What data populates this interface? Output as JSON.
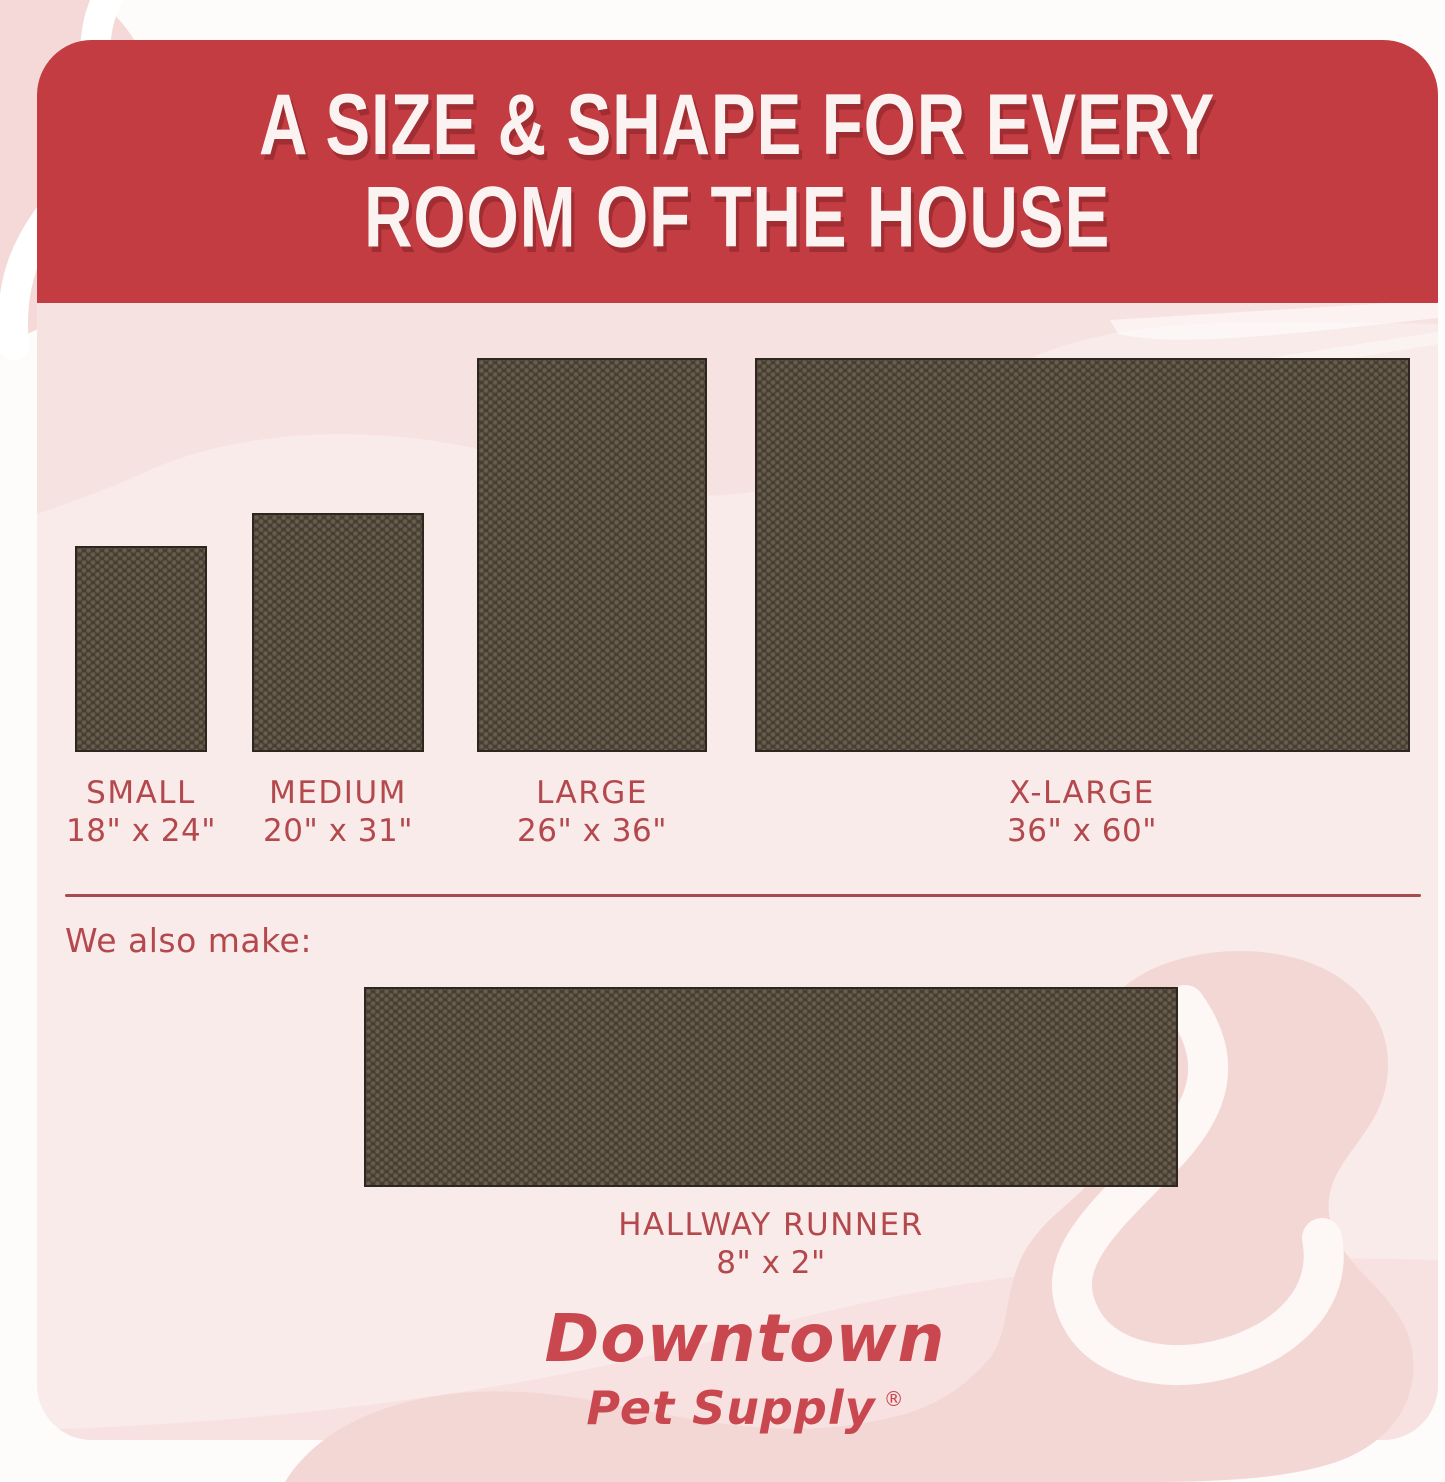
{
  "header": {
    "title_line1": "A SIZE & SHAPE FOR EVERY",
    "title_line2": "ROOM OF THE HOUSE"
  },
  "sizes": [
    {
      "name": "SMALL",
      "dimensions": "18\" x 24\""
    },
    {
      "name": "MEDIUM",
      "dimensions": "20\" x 31\""
    },
    {
      "name": "LARGE",
      "dimensions": "26\" x 36\""
    },
    {
      "name": "X-LARGE",
      "dimensions": "36\" x 60\""
    }
  ],
  "also_make": {
    "intro": "We also make:",
    "name": "HALLWAY RUNNER",
    "dimensions": "8\" x 2\""
  },
  "brand": {
    "line1": "Downtown",
    "line2": "Pet Supply",
    "registered_mark": "®"
  },
  "colors": {
    "header_red": "#c23c42",
    "label_red": "#b4494d",
    "logo_red": "#c9474f",
    "card_pink": "#f9ebea",
    "decor_pink": "#f3d7d5",
    "mat_brown": "#463d33"
  }
}
